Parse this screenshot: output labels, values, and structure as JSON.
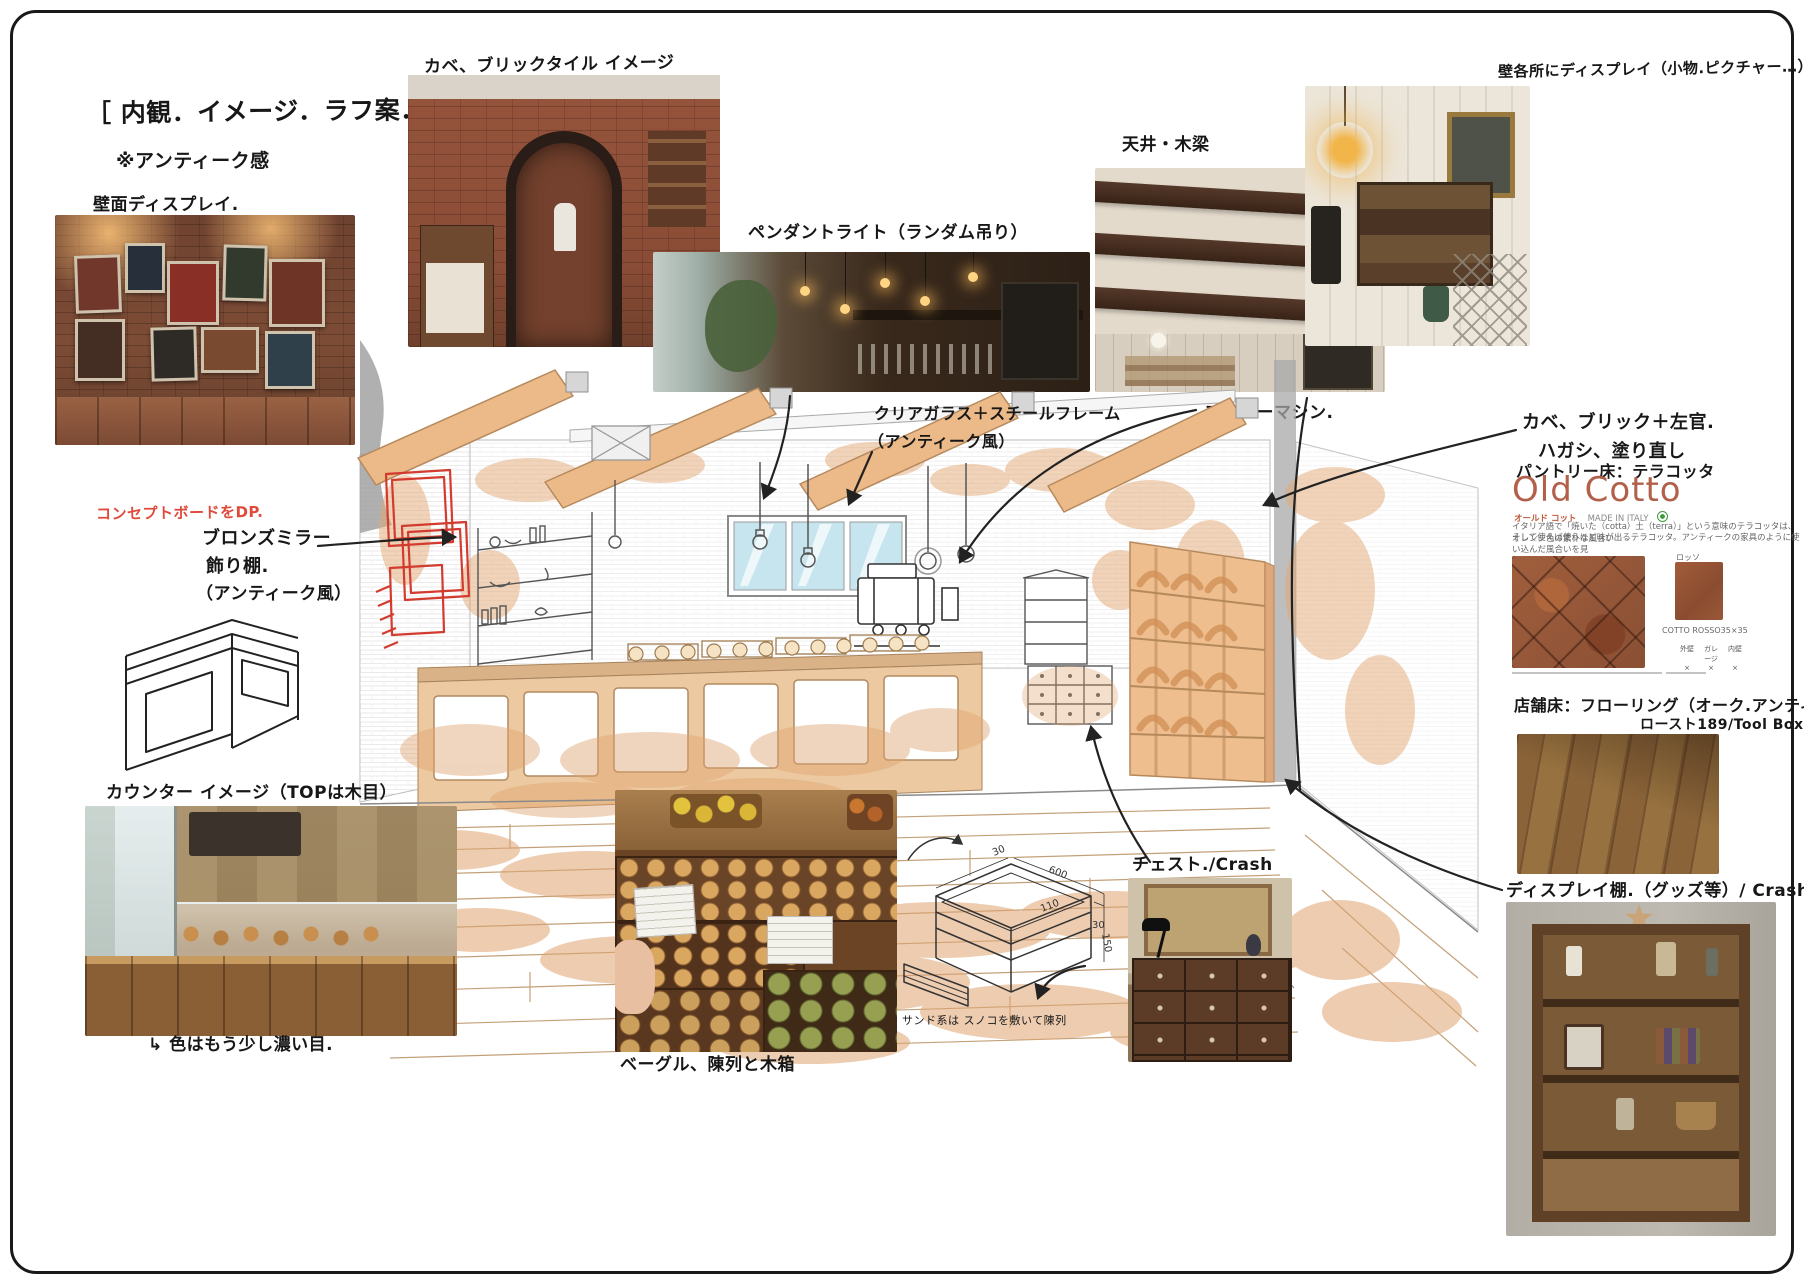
{
  "header": {
    "title": "［ 内観．イメージ．ラフ案．］",
    "note": "※アンティーク感"
  },
  "labels": {
    "wall_display": "壁面ディスプレイ.",
    "concept_board": "コンセプトボードをDP.",
    "brick_tile": "カベ、ブリックタイル イメージ",
    "pendant": "ペンダントライト（ランダム吊り）",
    "ceiling": "天井・木梁",
    "wall_spots": "壁各所にディスプレイ（小物.ピクチャー…）",
    "glass1": "クリアガラス＋スチールフレーム",
    "glass2": "（アンティーク風）",
    "coffee": "コーヒーマシン.",
    "plaster1": "カベ、ブリック＋左官.",
    "plaster2": "ハガシ、塗り直し",
    "pantry_floor": "パントリー床：テラコッタ",
    "mirror1": "ブロンズミラー",
    "mirror2": "飾り棚.",
    "mirror3": "（アンティーク風）",
    "counter": "カウンター イメージ（TOPは木目）",
    "counter_note": "↳ 色はもう少し濃い目.",
    "bagel": "ベーグル、陳列と木箱",
    "sunoko": "サンド系は スノコを敷いて陳列",
    "chest": "チェスト./Crash",
    "display_shelf": "ディスプレイ棚.（グッズ等）/ Crash",
    "floor1": "店舗床：フローリング（オーク.アンティーク）",
    "floor2": "ロースト189/Tool Box"
  },
  "old_cotto": {
    "brand": "Old Cotto",
    "brand_kana": "オールド コット",
    "made_in": "MADE IN ITALY",
    "desc1": "イタリア語で「焼いた（cotta）土（terra）」という意味のテラコッタは、オレンジ色の素朴な風合い",
    "desc2": "そして使えば使うほど味が出るテラコッタ。アンティークの家具のように使い込んだ風合いを見",
    "swatch_label": "ロッソ",
    "product_code": "COTTO ROSSO35×35",
    "spec_headers": [
      "外壁",
      "ガレージ",
      "内壁"
    ],
    "spec_marks": [
      "×",
      "×",
      "×"
    ]
  },
  "crate": {
    "dims": {
      "w": "600",
      "d": "110",
      "t": "30",
      "t2": "30",
      "h": "150"
    }
  },
  "colors": {
    "accent_red": "#e04a3c",
    "terracotta": "#b2604a",
    "wash_orange": "#e2a876",
    "sketch_red": "#d23b2e"
  }
}
